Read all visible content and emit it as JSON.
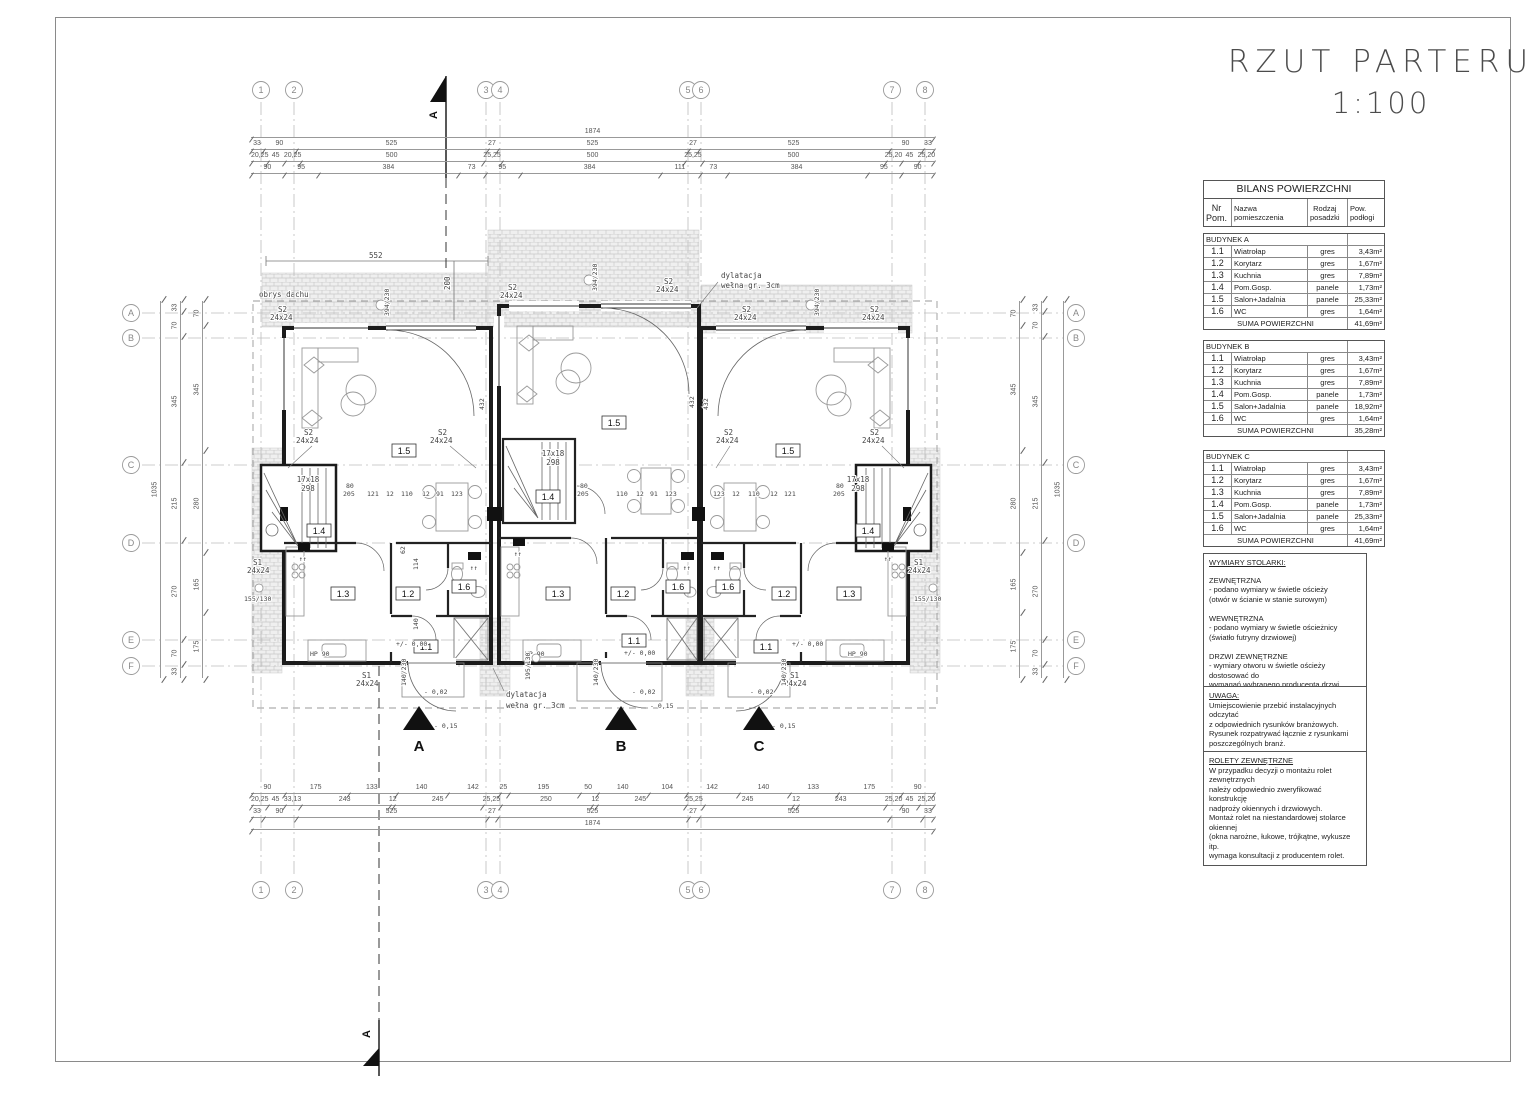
{
  "sheet": {
    "title_line1": "RZUT PARTERU",
    "title_line2": "1:100"
  },
  "grid": {
    "cols": [
      "1",
      "2",
      "3",
      "4",
      "5",
      "6",
      "7",
      "8"
    ],
    "rows": [
      "A",
      "B",
      "C",
      "D",
      "E",
      "F"
    ]
  },
  "balance_table": {
    "title": "BILANS POWIERZCHNI",
    "col_nr": "Nr\nPom.",
    "col_name": "Nazwa pomieszczenia",
    "col_floor": "Rodzaj\nposadzki",
    "col_area": "Pow.\npodłogi",
    "suma_label": "SUMA POWIERZCHNI",
    "buildings": [
      {
        "name": "BUDYNEK A",
        "suma": "41,69m²",
        "rows": [
          [
            "1.1",
            "Wiatrołap",
            "gres",
            "3,43m²"
          ],
          [
            "1.2",
            "Korytarz",
            "gres",
            "1,67m²"
          ],
          [
            "1.3",
            "Kuchnia",
            "gres",
            "7,89m²"
          ],
          [
            "1.4",
            "Pom.Gosp.",
            "panele",
            "1,73m²"
          ],
          [
            "1.5",
            "Salon+Jadalnia",
            "panele",
            "25,33m²"
          ],
          [
            "1.6",
            "WC",
            "gres",
            "1,64m²"
          ]
        ]
      },
      {
        "name": "BUDYNEK B",
        "suma": "35,28m²",
        "rows": [
          [
            "1.1",
            "Wiatrołap",
            "gres",
            "3,43m²"
          ],
          [
            "1.2",
            "Korytarz",
            "gres",
            "1,67m²"
          ],
          [
            "1.3",
            "Kuchnia",
            "gres",
            "7,89m²"
          ],
          [
            "1.4",
            "Pom.Gosp.",
            "panele",
            "1,73m²"
          ],
          [
            "1.5",
            "Salon+Jadalnia",
            "panele",
            "18,92m²"
          ],
          [
            "1.6",
            "WC",
            "gres",
            "1,64m²"
          ]
        ]
      },
      {
        "name": "BUDYNEK C",
        "suma": "41,69m²",
        "rows": [
          [
            "1.1",
            "Wiatrołap",
            "gres",
            "3,43m²"
          ],
          [
            "1.2",
            "Korytarz",
            "gres",
            "1,67m²"
          ],
          [
            "1.3",
            "Kuchnia",
            "gres",
            "7,89m²"
          ],
          [
            "1.4",
            "Pom.Gosp.",
            "panele",
            "1,73m²"
          ],
          [
            "1.5",
            "Salon+Jadalnia",
            "panele",
            "25,33m²"
          ],
          [
            "1.6",
            "WC",
            "gres",
            "1,64m²"
          ]
        ]
      }
    ]
  },
  "notes": [
    {
      "title": "WYMIARY STOLARKI:",
      "body": "ZEWNĘTRZNA\n- podano wymiary w świetle ościeży\n  (otwór w ścianie w stanie surowym)\n\nWEWNĘTRZNA\n- podano wymiary w świetle ościeżnicy\n  (światło futryny drzwiowej)\n\nDRZWI ZEWNĘTRZNE\n- wymiary otworu w świetle ościeży dostosować do\nwymagań wybranego producenta drzwi"
    },
    {
      "title": "UWAGA:",
      "body": "Umiejscowienie przebić instalacyjnych odczytać\nz odpowiednich rysunków branżowych.\nRysunek rozpatrywać łącznie z rysunkami\nposzczególnych branż."
    },
    {
      "title": "ROLETY ZEWNĘTRZNE",
      "body": "W przypadku decyzji o montażu rolet zewnętrznych\nnależy odpowiednio zweryfikować konstrukcję\nnadproży okiennych i drzwiowych.\nMontaż rolet na niestandardowej stolarce okiennej\n(okna narożne, łukowe, trójkątne, wykusze itp.\nwymaga konsultacji z producentem rolet."
    }
  ],
  "dims": {
    "top": {
      "total": "1874",
      "row2": [
        "33",
        "90",
        "525",
        "27",
        "525",
        "27",
        "525",
        "90",
        "33"
      ],
      "row3": [
        "20,25",
        "45",
        "20,25",
        "500",
        "25,25",
        "500",
        "25,25",
        "500",
        "25,20",
        "45",
        "25,20"
      ],
      "row4": [
        "90",
        "95",
        "384",
        "73",
        "95",
        "384",
        "111",
        "73",
        "384",
        "95",
        "90"
      ]
    },
    "bottom": {
      "row1": [
        "90",
        "175",
        "133",
        "140",
        "142",
        "25",
        "195",
        "50",
        "140",
        "104",
        "142",
        "140",
        "133",
        "175",
        "90"
      ],
      "row2": [
        "20,25",
        "45",
        "33,13",
        "243",
        "12",
        "245",
        "25,25",
        "250",
        "12",
        "245",
        "25,25",
        "245",
        "12",
        "243",
        "25,20",
        "45",
        "25,20"
      ],
      "row3": [
        "33",
        "90",
        "525",
        "27",
        "525",
        "27",
        "525",
        "90",
        "33"
      ],
      "total": "1874"
    },
    "left": {
      "total": "1035",
      "main": [
        "33",
        "70",
        "345",
        "215",
        "270",
        "70",
        "33"
      ],
      "inner": [
        "70",
        "345",
        "280",
        "165",
        "175"
      ]
    },
    "right": {
      "total": "1035",
      "main": [
        "33",
        "70",
        "345",
        "215",
        "270",
        "70",
        "33"
      ],
      "inner": [
        "70",
        "345",
        "280",
        "165",
        "175"
      ]
    }
  },
  "plan": {
    "roof_label": "obrys dachu",
    "dilat1": "dylatacja",
    "dilat2": "wełna gr. 3cm",
    "d552": "552",
    "d200": "200",
    "r15": "1.5",
    "r14": "1.4",
    "r13": "1.3",
    "r12": "1.2",
    "r16": "1.6",
    "r11": "1.1",
    "st1": "17x18",
    "st2": "298",
    "s1": "S1",
    "s2": "S2",
    "s24": "24x24",
    "m155": "155/130",
    "m195": "195/130",
    "m394": "394/230",
    "d80": "80",
    "d205": "205",
    "d140230": "140/230",
    "hp90": "HP  90",
    "lvl00": "+/- 0,00",
    "lvl02": "- 0,02",
    "lvl15": "- 0,15",
    "up": "↑↑",
    "entA": "A",
    "entB": "B",
    "entC": "C",
    "sec": "A",
    "d432": "432",
    "d121": "121",
    "d123": "123",
    "d110": "110",
    "d12": "12",
    "d91": "91",
    "d114": "114",
    "d62": "62",
    "d140": "140"
  }
}
